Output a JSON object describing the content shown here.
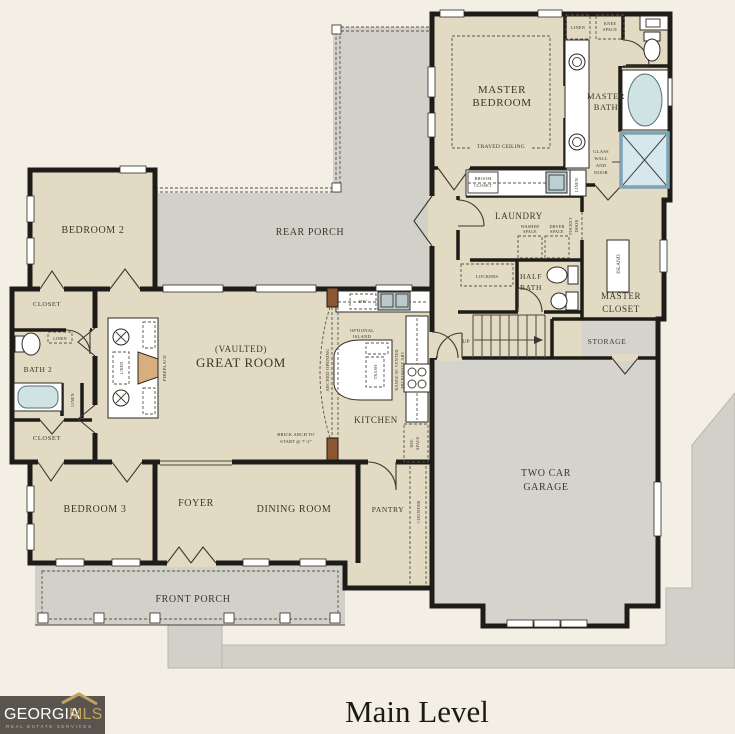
{
  "title": {
    "text": "Main Level"
  },
  "logo": {
    "brand_white": "GEORGIA",
    "brand_gold": "MLS",
    "tagline": "REAL ESTATE SERVICES",
    "bg": "#59554e",
    "gold": "#c2a35e"
  },
  "colors": {
    "page_bg": "#f3efe4",
    "room_tan": "#e2dac3",
    "porch_gray": "#d1d0c9",
    "wall": "#1e1c18",
    "water_blue": "#cfe3e2",
    "shower_frame": "#7fa3b5",
    "wood_accent": "#d9ae7e",
    "arch_post": "#8d5632"
  },
  "labels": {
    "master_bedroom_1": "MASTER",
    "master_bedroom_2": "BEDROOM",
    "trayed": "TRAYED CEILING",
    "master_bath_1": "MASTER",
    "master_bath_2": "BATH",
    "linen_mb_top": "LINEN",
    "knee_1": "KNEE",
    "knee_2": "SPACE",
    "glass_1": "GLASS",
    "glass_2": "WALL",
    "glass_3": "AND",
    "glass_4": "DOOR",
    "broom_1": "BROOM",
    "broom_2": "CLOSET",
    "linen_broom": "LINEN",
    "laundry": "LAUNDRY",
    "washer_1": "WASHER",
    "washer_2": "SPACE",
    "dryer_1": "DRYER",
    "dryer_2": "SPACE",
    "pocket_1": "POCKET",
    "pocket_2": "DOOR",
    "island_mc": "ISLAND",
    "master_closet_1": "MASTER",
    "master_closet_2": "CLOSET",
    "half_bath_1": "HALF",
    "half_bath_2": "BATH",
    "lockers": "LOCKERS",
    "storage": "STORAGE",
    "up": "UP",
    "garage_1": "TWO CAR",
    "garage_2": "GARAGE",
    "rear_porch": "REAR PORCH",
    "bedroom2": "BEDROOM 2",
    "closet_b2": "CLOSET",
    "linen_bath2_h": "LINEN",
    "bath2": "BATH 2",
    "linen_bath2_v": "LINEN",
    "closet_b3": "CLOSET",
    "great_room_1": "(VAULTED)",
    "great_room_2": "GREAT ROOM",
    "fireplace": "FIREPLACE",
    "linen_fp": "LINEN",
    "arched_opening": "ARCHED OPENING",
    "optional_1": "OPTIONAL",
    "optional_2": "ISLAND",
    "trash": "TRASH",
    "kitchen": "KITCHEN",
    "dw": "DW",
    "range_1": "RANGE W/ VENTED",
    "range_2": "MICROWAVE ABV",
    "ref_1": "REF.",
    "ref_2": "SPACE",
    "brick_1": "BRICK ARCH TO",
    "brick_2": "START @ 7'-2\"",
    "pantry": "PANTRY",
    "counter": "COUNTER",
    "bedroom3": "BEDROOM 3",
    "foyer": "FOYER",
    "dining": "DINING ROOM",
    "front_porch": "FRONT PORCH"
  }
}
